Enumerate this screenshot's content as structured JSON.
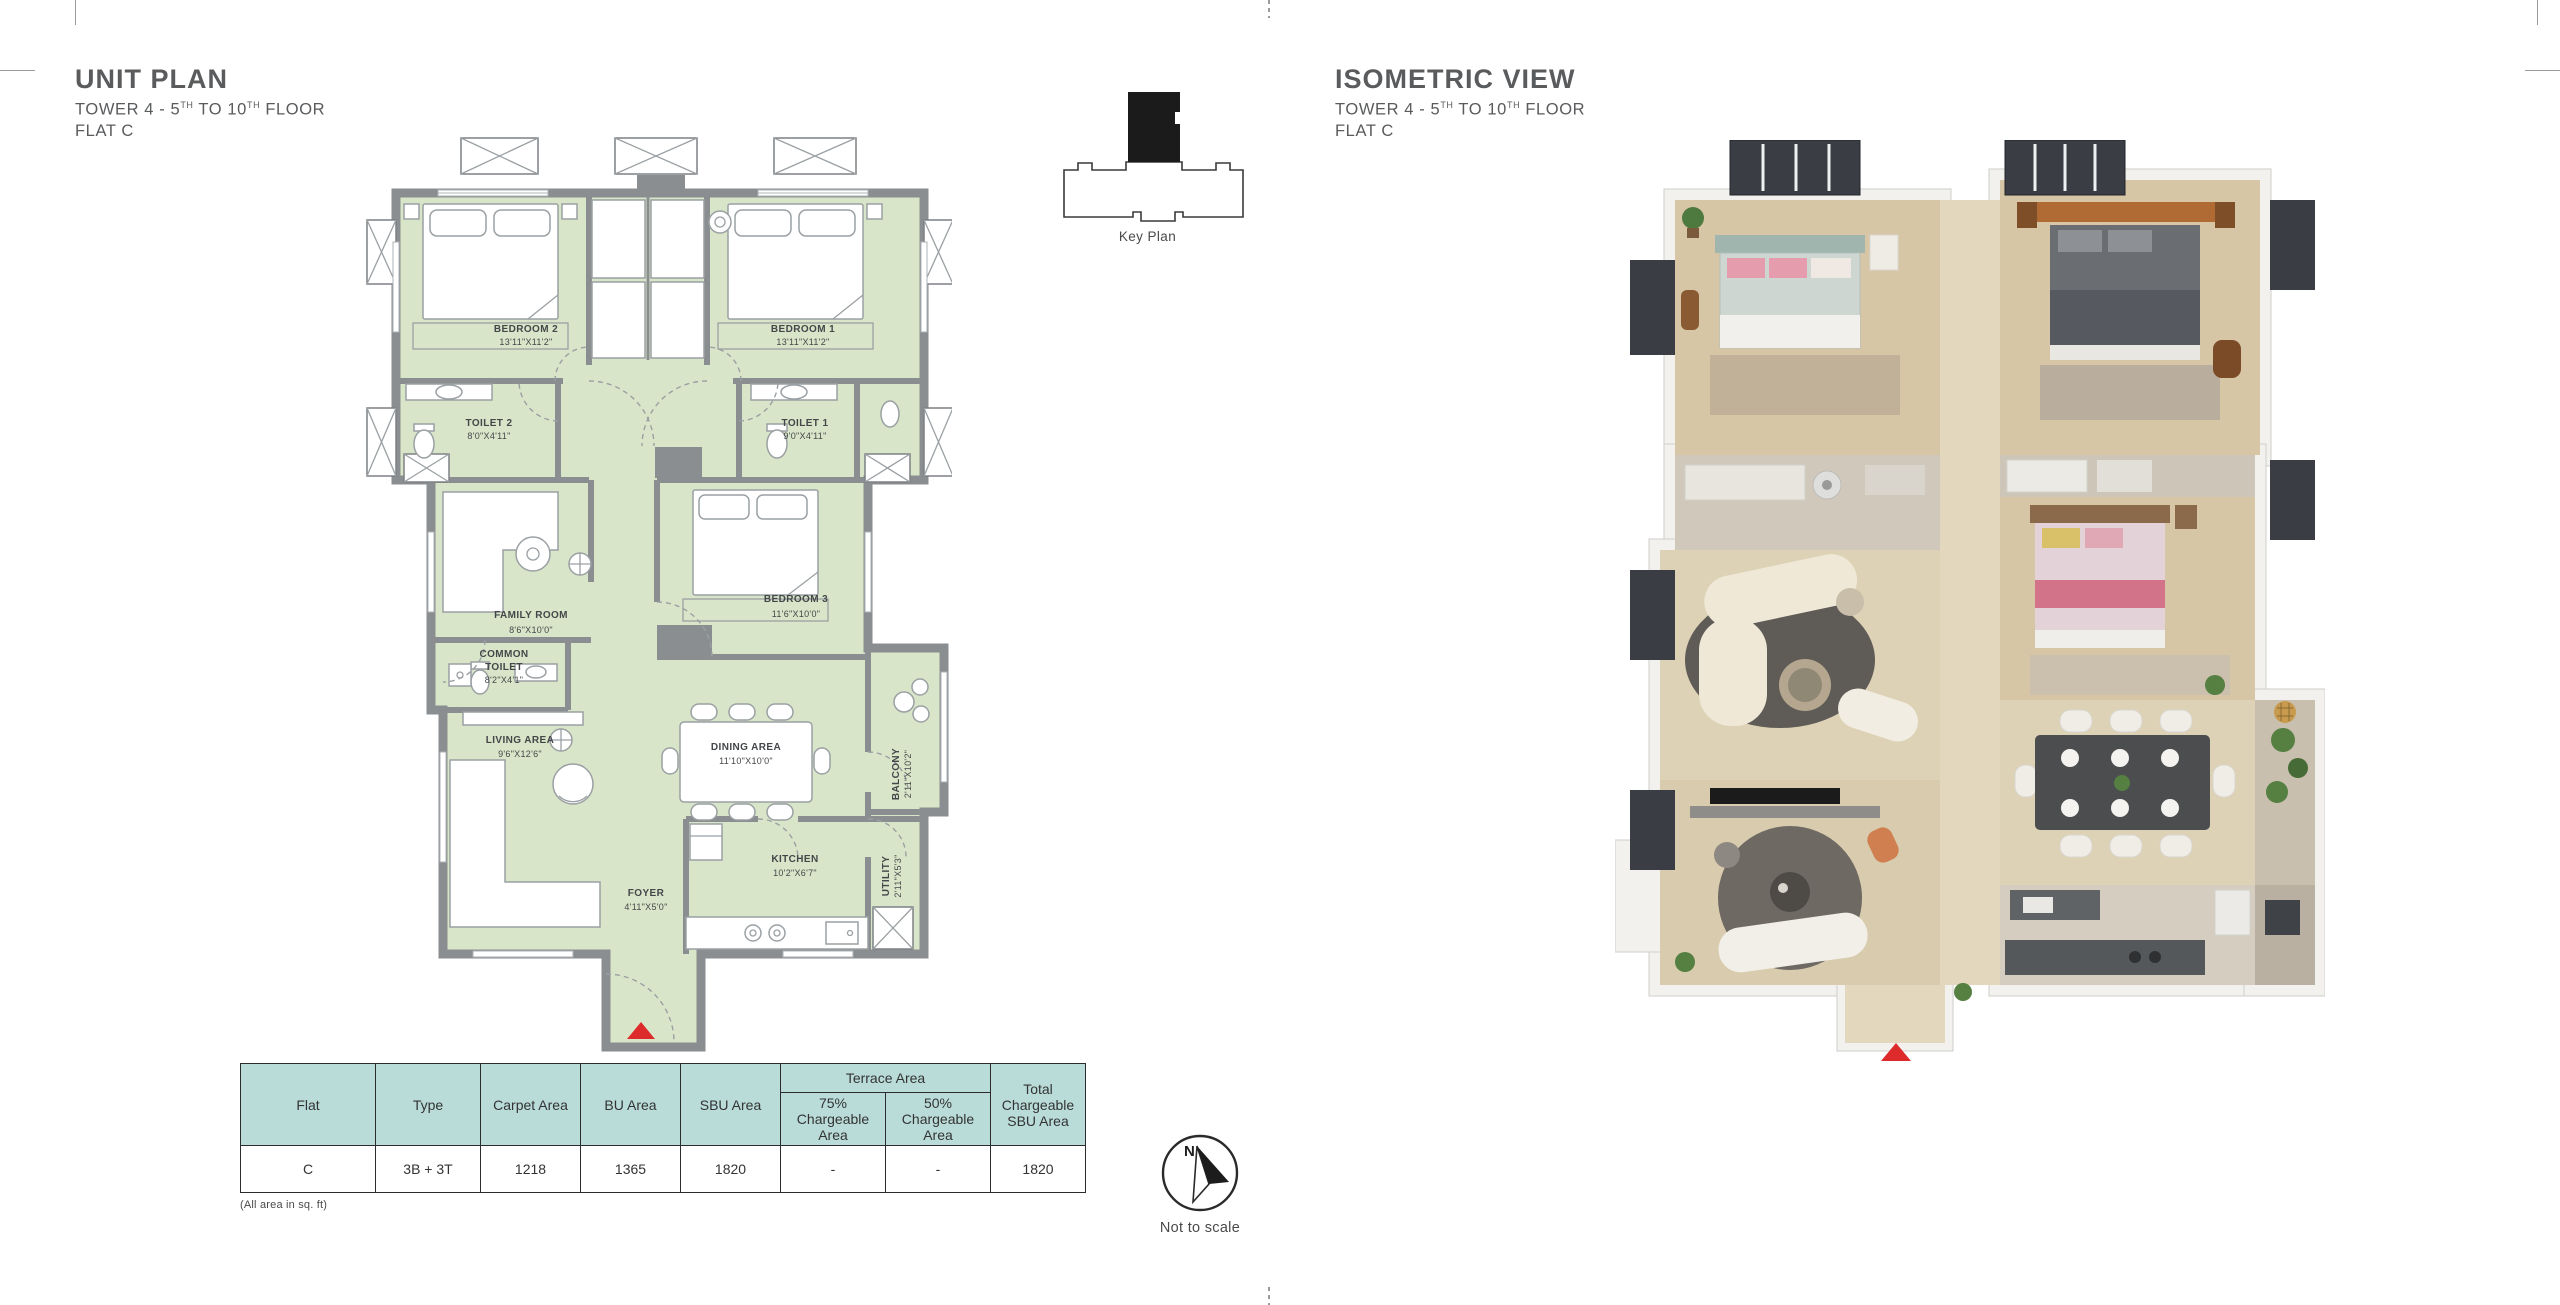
{
  "unit_plan": {
    "title": "UNIT PLAN"
  },
  "isometric": {
    "title": "ISOMETRIC VIEW"
  },
  "subtitle": {
    "p1": "TOWER 4 - 5",
    "s1": "TH",
    "p2": " TO 10",
    "s2": "TH",
    "p3": " FLOOR",
    "line2": "FLAT C"
  },
  "key_plan": {
    "label": "Key Plan"
  },
  "rooms": {
    "bedroom2": {
      "name": "BEDROOM 2",
      "dim": "13'11\"X11'2\""
    },
    "bedroom1": {
      "name": "BEDROOM 1",
      "dim": "13'11\"X11'2\""
    },
    "toilet2": {
      "name": "TOILET 2",
      "dim": "8'0\"X4'11\""
    },
    "toilet1": {
      "name": "TOILET 1",
      "dim": "9'0\"X4'11\""
    },
    "family": {
      "name": "FAMILY ROOM",
      "dim": "8'6\"X10'0\""
    },
    "bedroom3": {
      "name": "BEDROOM 3",
      "dim": "11'6\"X10'0\""
    },
    "common_toilet": {
      "line1": "COMMON",
      "line2": "TOILET",
      "dim": "8'2\"X4'1\""
    },
    "living": {
      "name": "LIVING AREA",
      "dim": "9'6\"X12'6\""
    },
    "dining": {
      "name": "DINING AREA",
      "dim": "11'10\"X10'0\""
    },
    "balcony": {
      "name": "BALCONY",
      "dim": "2'11\"X10'2\""
    },
    "kitchen": {
      "name": "KITCHEN",
      "dim": "10'2\"X6'7\""
    },
    "utility": {
      "name": "UTILITY",
      "dim": "2'11\"X5'3\""
    },
    "foyer": {
      "name": "FOYER",
      "dim": "4'11\"X5'0\""
    }
  },
  "table": {
    "headers": {
      "flat": "Flat",
      "type": "Type",
      "carpet": "Carpet Area",
      "bu": "BU Area",
      "sbu": "SBU Area",
      "terrace": "Terrace Area",
      "terrace75": "75% Chargeable Area",
      "terrace50": "50% Chargeable Area",
      "total": "Total Chargeable SBU Area"
    },
    "row": {
      "flat": "C",
      "type": "3B + 3T",
      "carpet": "1218",
      "bu": "1365",
      "sbu": "1820",
      "terrace75": "-",
      "terrace50": "-",
      "total": "1820"
    },
    "note": "(All area in sq. ft)"
  },
  "compass": {
    "n": "N",
    "note": "Not to scale"
  },
  "colors": {
    "plan_green": "#d9e5c8",
    "wall_gray": "#8a8e91",
    "accent_red": "#dd2b2b",
    "table_header_teal": "#b9dcd9",
    "title_gray": "#595b5d",
    "iso_floor": "#d7c6a6"
  }
}
